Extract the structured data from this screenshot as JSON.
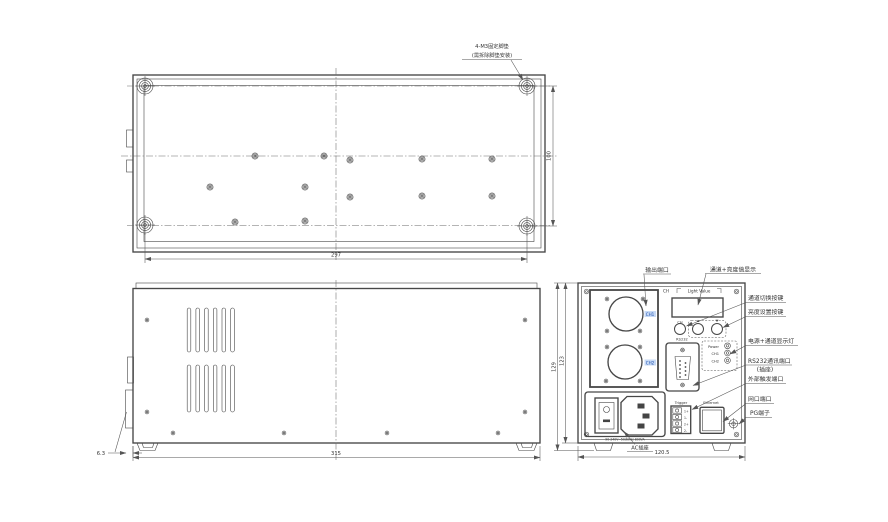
{
  "annotation": {
    "feet_line1": "4-M3固定脚垫",
    "feet_line2": "(需拆除脚垫安装)"
  },
  "dims": {
    "bottom_width": "297",
    "bottom_depth": "100",
    "side_width": "315",
    "side_offset": "6.3",
    "rear_width": "120.5",
    "rear_height_outer": "129",
    "rear_height_inner": "123"
  },
  "panel": {
    "ch_header": "CH",
    "light_value": "Light Value",
    "knob_ch": "CH",
    "out_ch1": "CH1",
    "out_ch2": "CH2",
    "rs232": "RS232",
    "led_power": "Power",
    "led_ch1": "CH1",
    "led_ch2": "CH2",
    "trigger": "Trigger",
    "pins": [
      "1+",
      "1-",
      "2+",
      "2-"
    ],
    "ethernet": "Ethernet",
    "ac_rating": "90-240V~50/60Hz 800VA"
  },
  "callouts": {
    "output_port": "输出端口",
    "display": "通道+亮度值显示",
    "ch_switch": "通道切换按键",
    "brightness": "亮度设置按键",
    "leds": "电源+通道显示灯",
    "rs232_1": "RS232通讯端口",
    "rs232_2": "(插座)",
    "trigger": "外部触发端口",
    "network": "网口端口",
    "pg": "PG端子",
    "ac": "AC插座"
  }
}
